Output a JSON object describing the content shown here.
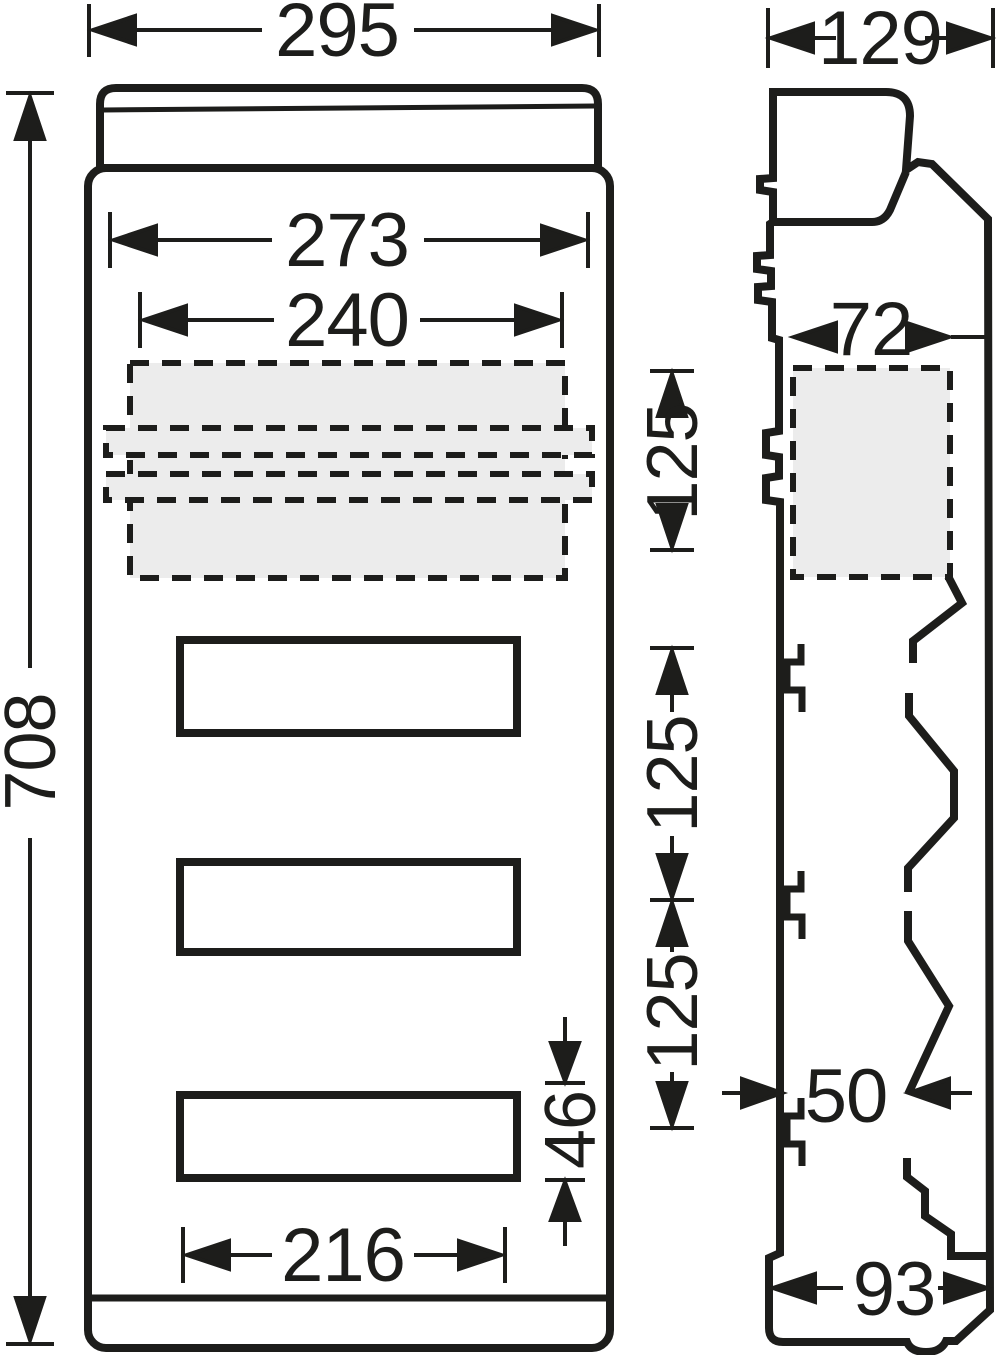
{
  "drawing": {
    "type": "technical-dimension-drawing",
    "views": [
      "front-view",
      "side-view"
    ],
    "units": "mm",
    "colors": {
      "line": "#1d1d1b",
      "body_fill": "#ffffff",
      "knockout_fill": "#ececec"
    },
    "front_view": {
      "overall_width": "295",
      "overall_height": "708",
      "opening_width": "273",
      "rail_width": "240",
      "row_spacing_top": "125",
      "row_spacing_middle": "125",
      "row_spacing_bottom": "125",
      "window_width": "216",
      "window_height": "46",
      "window_count": 3,
      "knockout_areas": 3
    },
    "side_view": {
      "depth": "129",
      "flange_depth": "72",
      "inner_depth": "50",
      "base_depth": "93"
    }
  }
}
